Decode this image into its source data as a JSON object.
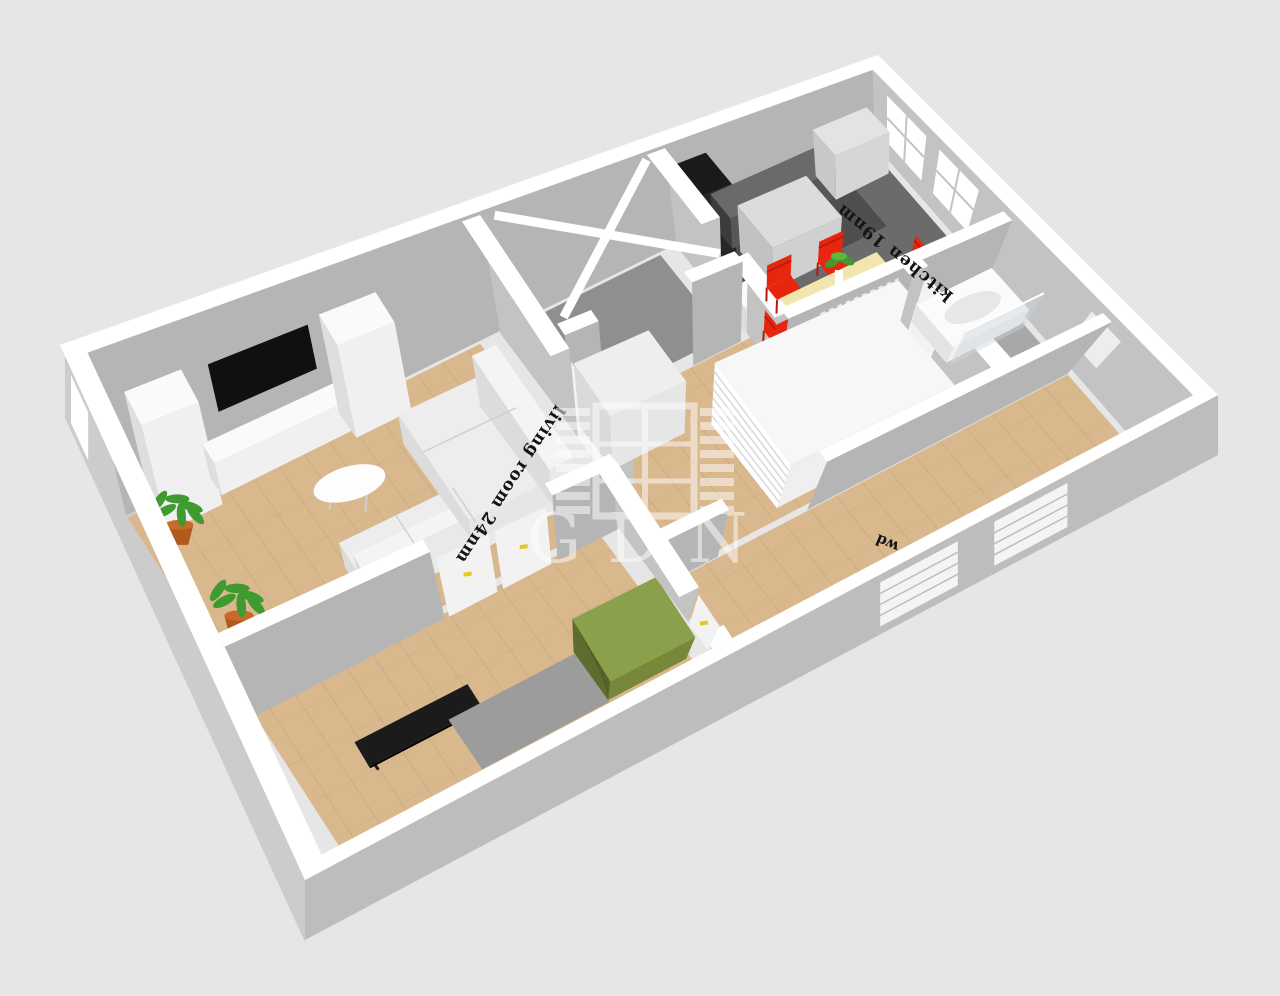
{
  "scene": {
    "type": "3d-floorplan-render",
    "description": "isometric 3D apartment floor plan"
  },
  "labels": {
    "living_room": "living room 24nm",
    "kitchen": "kitchen 19nm",
    "fragment": "wd"
  },
  "watermark": {
    "text": "GDN",
    "icon": "shuttered-window-icon",
    "opacity": "0.5"
  },
  "colors": {
    "background": "#e6e6e6",
    "wall_top": "#ffffff",
    "wall_face": "#b5b5b5",
    "wall_face_light": "#c3c3c3",
    "ext_face": "#bdbdbd",
    "ext_face_light": "#cccccc",
    "wood": "#d9b88e",
    "wood_stripe": "#c3a176",
    "kitchen_floor": "#6b6b6b",
    "kitchen_floor_dark": "#4e4e4e",
    "entry_floor": "#8f8f8f",
    "bath_floor": "#a8a8a8",
    "rug": "#9c9c9c",
    "furniture_white_top": "#fafafa",
    "furniture_white_w": "#dedede",
    "furniture_white_s": "#f0f0f0",
    "sofa_white": "#ededed",
    "counter_top": "#6a6a6a",
    "counter_w": "#3c3c3c",
    "counter_s": "#575757",
    "fridge_black": "#0d0d0d",
    "tv_black": "#101010",
    "table_cream": "#f1e7ae",
    "table_edge": "#ddd09a",
    "table_leg": "#d8c088",
    "chair_red": "#e8250e",
    "chair_red_dark": "#b01a08",
    "green_top": "#8ba04a",
    "green_mid": "#77883b",
    "green_dark": "#5e6c2d",
    "pot": "#b05a1e",
    "pot_rim": "#c96a2a",
    "plant_green": "#3f9b2f",
    "handle_yellow": "#e6c81e",
    "console_black": "#1b1b1b",
    "glass": "#c9d6da",
    "label_ink": "#141414",
    "watermark_white": "#ffffff"
  }
}
